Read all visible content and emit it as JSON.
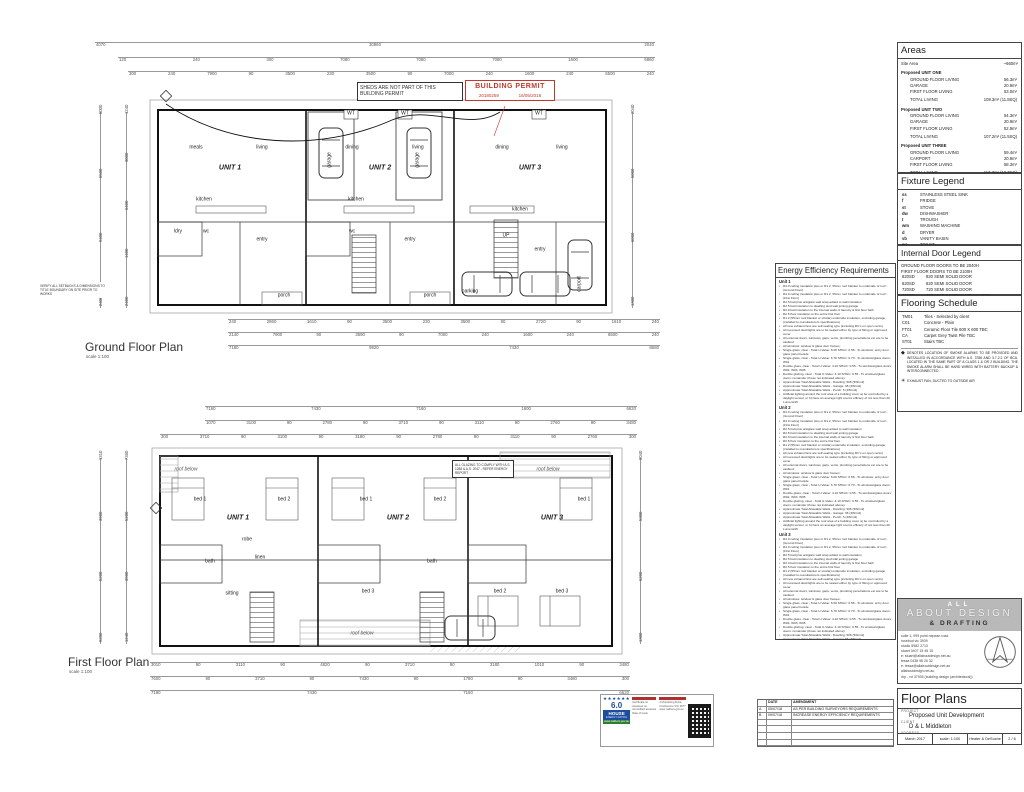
{
  "permit_note": "SHEDS ARE NOT PART OF THIS BUILDING PERMIT",
  "permit_stamp": {
    "title": "BUILDING PERMIT",
    "number": "20180259",
    "date": "16/05/2018"
  },
  "ground": {
    "title": "Ground Floor Plan",
    "scale": "scale 1:100",
    "dims_top1": [
      "4070",
      "30960",
      "2040"
    ],
    "dims_top2": [
      "120",
      "240",
      "300",
      "7080",
      "7080",
      "7080",
      "1600",
      "6860"
    ],
    "dims_top3": [
      "300",
      "240",
      "7900",
      "90",
      "3500",
      "230",
      "3500",
      "90",
      "7000",
      "240",
      "1600",
      "240",
      "6500",
      "240"
    ],
    "dims_bottom1": [
      "240",
      "2860",
      "1610",
      "90",
      "3500",
      "230",
      "3500",
      "90",
      "2720",
      "90",
      "1610",
      "240"
    ],
    "dims_bottom2": [
      "2140",
      "7900",
      "90",
      "3590",
      "90",
      "7000",
      "240",
      "1600",
      "240",
      "6500",
      "240"
    ],
    "dims_bottom3": [
      "7180",
      "9920",
      "7430",
      "8680"
    ],
    "dims_left1": [
      "5000",
      "5500",
      "9400",
      "2400"
    ],
    "dims_left2": [
      "1240",
      "3000",
      "6400",
      "1400",
      "2400"
    ],
    "dims_right": [
      "2040",
      "5000",
      "6000",
      "1300"
    ],
    "labels": [
      {
        "x": 230,
        "y": 168,
        "t": "UNIT 1",
        "c": "unit"
      },
      {
        "x": 196,
        "y": 148,
        "t": "meals"
      },
      {
        "x": 262,
        "y": 148,
        "t": "living"
      },
      {
        "x": 204,
        "y": 200,
        "t": "kitchen"
      },
      {
        "x": 178,
        "y": 232,
        "t": "ldry"
      },
      {
        "x": 206,
        "y": 232,
        "t": "wc"
      },
      {
        "x": 262,
        "y": 240,
        "t": "entry"
      },
      {
        "x": 284,
        "y": 296,
        "t": "porch"
      },
      {
        "x": 330,
        "y": 160,
        "t": "garage",
        "c": "rot"
      },
      {
        "x": 380,
        "y": 168,
        "t": "UNIT 2",
        "c": "unit"
      },
      {
        "x": 352,
        "y": 148,
        "t": "dining"
      },
      {
        "x": 418,
        "y": 148,
        "t": "living"
      },
      {
        "x": 356,
        "y": 200,
        "t": "kitchen"
      },
      {
        "x": 418,
        "y": 160,
        "t": "garage",
        "c": "rot"
      },
      {
        "x": 352,
        "y": 232,
        "t": "wc"
      },
      {
        "x": 410,
        "y": 240,
        "t": "entry"
      },
      {
        "x": 430,
        "y": 296,
        "t": "porch"
      },
      {
        "x": 530,
        "y": 168,
        "t": "UNIT 3",
        "c": "unit"
      },
      {
        "x": 562,
        "y": 148,
        "t": "living"
      },
      {
        "x": 502,
        "y": 148,
        "t": "dining"
      },
      {
        "x": 520,
        "y": 210,
        "t": "kitchen"
      },
      {
        "x": 506,
        "y": 236,
        "t": "UP"
      },
      {
        "x": 540,
        "y": 250,
        "t": "entry"
      },
      {
        "x": 470,
        "y": 292,
        "t": "parking"
      },
      {
        "x": 580,
        "y": 284,
        "t": "carport",
        "c": "rot"
      },
      {
        "x": 351,
        "y": 114,
        "t": "WT"
      },
      {
        "x": 405,
        "y": 114,
        "t": "WT"
      },
      {
        "x": 539,
        "y": 114,
        "t": "WT"
      }
    ]
  },
  "first": {
    "title": "First Floor Plan",
    "scale": "scale 1:100",
    "dims_top1": [
      "7160",
      "7430",
      "7160",
      "1600",
      "6620"
    ],
    "dims_top2": [
      "1070",
      "3100",
      "90",
      "2780",
      "90",
      "3710",
      "90",
      "3110",
      "90",
      "2760",
      "90",
      "3480"
    ],
    "dims_top3": [
      "300",
      "3710",
      "90",
      "3100",
      "90",
      "3180",
      "90",
      "2780",
      "90",
      "3110",
      "90",
      "2760",
      "300"
    ],
    "dims_bottom1": [
      "3010",
      "90",
      "3110",
      "90",
      "4820",
      "90",
      "3710",
      "90",
      "3180",
      "1010",
      "90",
      "3480"
    ],
    "dims_bottom2": [
      "7600",
      "90",
      "3710",
      "90",
      "7430",
      "90",
      "1780",
      "90",
      "3480",
      "300"
    ],
    "dims_bottom3": [
      "7180",
      "7430",
      "7160",
      "6620"
    ],
    "dims_left1": [
      "1310",
      "3900",
      "5200",
      "9200"
    ],
    "dims_left2": [
      "7360",
      "5200",
      "3900",
      "1240"
    ],
    "dims_right": [
      "3040",
      "5300",
      "6200",
      "1300"
    ],
    "labels": [
      {
        "x": 238,
        "y": 518,
        "t": "UNIT 1",
        "c": "unit"
      },
      {
        "x": 200,
        "y": 500,
        "t": "bed 1"
      },
      {
        "x": 284,
        "y": 500,
        "t": "bed 2"
      },
      {
        "x": 247,
        "y": 540,
        "t": "robe"
      },
      {
        "x": 210,
        "y": 562,
        "t": "bath"
      },
      {
        "x": 260,
        "y": 558,
        "t": "linen"
      },
      {
        "x": 232,
        "y": 594,
        "t": "sitting"
      },
      {
        "x": 398,
        "y": 518,
        "t": "UNIT 2",
        "c": "unit"
      },
      {
        "x": 366,
        "y": 500,
        "t": "bed 1"
      },
      {
        "x": 440,
        "y": 500,
        "t": "bed 2"
      },
      {
        "x": 368,
        "y": 592,
        "t": "bed 3"
      },
      {
        "x": 432,
        "y": 562,
        "t": "bath"
      },
      {
        "x": 552,
        "y": 518,
        "t": "UNIT 3",
        "c": "unit"
      },
      {
        "x": 584,
        "y": 500,
        "t": "bed 1"
      },
      {
        "x": 500,
        "y": 592,
        "t": "bed 2"
      },
      {
        "x": 562,
        "y": 592,
        "t": "bed 3"
      },
      {
        "x": 548,
        "y": 470,
        "t": "roof below",
        "c": "it"
      },
      {
        "x": 362,
        "y": 634,
        "t": "roof below",
        "c": "it"
      },
      {
        "x": 186,
        "y": 470,
        "t": "roof below",
        "c": "it"
      }
    ]
  },
  "notes_small": {
    "glazing": "ALL GLAZING TO COMPLY WITH A.S. 1288 & A.S. 2047 - REFER ENERGY REPORT",
    "boundary": "VERIFY ALL SETBACKS & DIMENSIONS TO TITLE BOUNDARY ON SITE PRIOR TO WORKS"
  },
  "energy": {
    "title": "Energy Efficiency Requirements",
    "sections": [
      "Unit 1",
      "Unit 2",
      "Unit 3"
    ],
    "bullets": [
      "R4.0 ceiling insulation plus or R1.2, 55mm roof blanket to underside of roof - (Ground Floor)",
      "R4.0 ceiling insulation plus or R1.2, 55mm roof blanket to underside of roof - (First Floor)",
      "R2.5 batt plus antiglare wall wrap added to wall insulation",
      "R2.5 batt insulation to dwelling stud wall joining garage",
      "R2.0 batt insulation to the internal walls of laundry & first floor bath",
      "R2.5 floor insulation to the entire first floor",
      "R1.2 (55mm roof blanket or similar) underside insulation, excluding garage (installed to manufacturers specifications)",
      "All new exhaust fans are self-sealing type (including RC's on open vents)",
      "All recessed downlights are to be sealed either by type of fitting or approved cover",
      "All external doors, windows, gaps, vents, plumbing penetrations etc are to be caulked",
      "All windows: window & glass door frames:",
      "Single glass, clear - Total U-Value: 6.00 SHGC: 0.58 - To windows: entry door glass panel beside",
      "Single glass, clear - Total U-Value: 6.70 SHGC: 0.70 - To windows/glass doors: W01",
      "Double glass, clear - Total U-Value: 4.10 SHGC: 0.55 - To windows/glass doors: W02, W03, W05",
      "Double glazing, clear - Total U-Value: 4.10 SHGC: 0.55 - To windows/glass doors: remainder (those not indicated above)",
      "Approximate Total Allowable Watts - Dwelling: 506 (5W/m2)",
      "Approximate Total Allowable Watts - Garage: 66 (3W/m2)",
      "Approximate Total Allowable Watts - Porch: 5 (4W/m2)",
      "Artificial lighting around the roof area of a building must: a) be controlled by a daylight sensor, or b) have an average light source efficacy of not less than 40 Lumens/W"
    ]
  },
  "areas": {
    "title": "Areas",
    "site_label": "Site Area",
    "site_value": "~660m²",
    "units": [
      {
        "name": "Proposed UNIT ONE",
        "rows": [
          [
            "GROUND FLOOR LIVING",
            "56.3m²"
          ],
          [
            "GARAGE",
            "20.9m²"
          ],
          [
            "FIRST FLOOR LIVING",
            "53.0m²"
          ]
        ],
        "total": [
          "TOTAL LIVING",
          "109.3m² (11.8SQ)"
        ]
      },
      {
        "name": "Proposed UNIT TWO",
        "rows": [
          [
            "GROUND FLOOR LIVING",
            "54.3m²"
          ],
          [
            "GARAGE",
            "20.9m²"
          ],
          [
            "FIRST FLOOR LIVING",
            "52.9m²"
          ]
        ],
        "total": [
          "TOTAL LIVING",
          "107.2m² (11.5SQ)"
        ]
      },
      {
        "name": "Proposed UNIT THREE",
        "rows": [
          [
            "GROUND FLOOR LIVING",
            "59.4m²"
          ],
          [
            "CARPORT",
            "20.9m²"
          ],
          [
            "FIRST FLOOR LIVING",
            "58.3m²"
          ]
        ],
        "total": [
          "TOTAL LIVING",
          "117.7m² (12.7SQ)"
        ]
      }
    ]
  },
  "fixture_legend": {
    "title": "Fixture Legend",
    "rows": [
      [
        "ss",
        "STAINLESS STEEL SINK"
      ],
      [
        "f",
        "FRIDGE"
      ],
      [
        "st",
        "STOVE"
      ],
      [
        "dw",
        "DISHWASHER"
      ],
      [
        "t",
        "TROUGH"
      ],
      [
        "wm",
        "WASHING MACHINE"
      ],
      [
        "d",
        "DRYER"
      ],
      [
        "vb",
        "VANITY BASIN"
      ],
      [
        "wc",
        "TOILET"
      ],
      [
        "sh",
        "SHOWER"
      ],
      [
        "b",
        "BATH"
      ],
      [
        "dp",
        "DOWNPIPE"
      ]
    ]
  },
  "door_legend": {
    "title": "Internal Door Legend",
    "note1": "GROUND FLOOR DOORS TO BE 2040H",
    "note2": "FIRST FLOOR DOORS TO BE 2100H",
    "rows": [
      [
        "820SD",
        "820 SEMI SOLID DOOR"
      ],
      [
        "620SD",
        "620 SEMI SOLID DOOR"
      ],
      [
        "720SD",
        "720 SEMI SOLID DOOR"
      ],
      [
        "720CS",
        "720 SEMI SOLID CAVITY SLIDER"
      ]
    ]
  },
  "flooring": {
    "title": "Flooring Schedule",
    "rows": [
      [
        "TM01",
        "Tiles - Selected by client"
      ],
      [
        "C01",
        "Concrete - Plain"
      ],
      [
        "FT01",
        "Ceramic Floor Tile 600 X 600 TBC"
      ],
      [
        "CA",
        "Carpet Grey Twist Pile TBC"
      ],
      [
        "ST01",
        "Stairs TBC"
      ]
    ],
    "smoke_icon": "◆",
    "smoke_note": "DENOTES LOCATION OF SMOKE ALARMS TO BE PROVIDED AND INSTALLED IN ACCORDANCE WITH A.S. 3786 AND 3.7.2.2 OF BCA. LOCATED IN THE SAME PART OF A CLASS 1 & OR 2 BUILDING. THE SMOKE ALARM SHALL BE HARD WIRED WITH BATTERY BACKUP & INTERCONNECTED.",
    "fan_icon": "✳",
    "fan_note": "EXHAUST FAN, DUCTED TO OUTSIDE AIR"
  },
  "brand": {
    "line1": "ALL",
    "line2": "ABOUT DESIGN",
    "line3": "& DRAFTING",
    "contact": [
      "suite 1, 999 point nepean road",
      "rosebud  vic 3939",
      "studio 5982 2713",
      "stuart 0407 15 45 15",
      "e: stuart@allaboutdesign.net.au",
      "tessa 0438 98 26 32",
      "e: tessa@allaboutdesign.net.au",
      "allaboutdesign.net.au",
      "rbp - vd 37935 (building design (architectural))"
    ]
  },
  "titleblock": {
    "section": "Floor Plans",
    "project_label": "PROJECT",
    "project": "Proposed Unit Development",
    "client_label": "CLIENT",
    "client": "D & L Middleton",
    "address_label": "ADDRESS",
    "address": "2 Mundaring Drive, Cranbourne",
    "date": "March 2017",
    "scale": "scale: 1:100",
    "drawn": "Heater & DeSoche",
    "sheet_no": "2 / 6"
  },
  "cert": {
    "stars": "★★★★★★",
    "rating": "6.0",
    "brand": "HOUSE",
    "brand_sub": "ENERGY RATING",
    "url": "www.nathers.gov.au",
    "col1": [
      "Certificate no.",
      "Assessor no.",
      "Accredited assessor",
      "Date of issue"
    ],
    "col2": [
      "2 Mundaring Drive,",
      "Cranbourne VIC 3977",
      "www.nathers.gov.au"
    ]
  },
  "amendments": {
    "headers": [
      "",
      "DATE",
      "AMENDMENT"
    ],
    "rows": [
      [
        "A",
        "05/07/18",
        "AS PER BUILDING SURVEYORS REQUIREMENTS"
      ],
      [
        "B",
        "09/07/18",
        "INCREASE ENERGY EFFICIENCY REQUIREMENTS"
      ],
      [
        "",
        "",
        ""
      ],
      [
        "",
        "",
        ""
      ],
      [
        "",
        "",
        ""
      ],
      [
        "",
        "",
        ""
      ]
    ]
  }
}
